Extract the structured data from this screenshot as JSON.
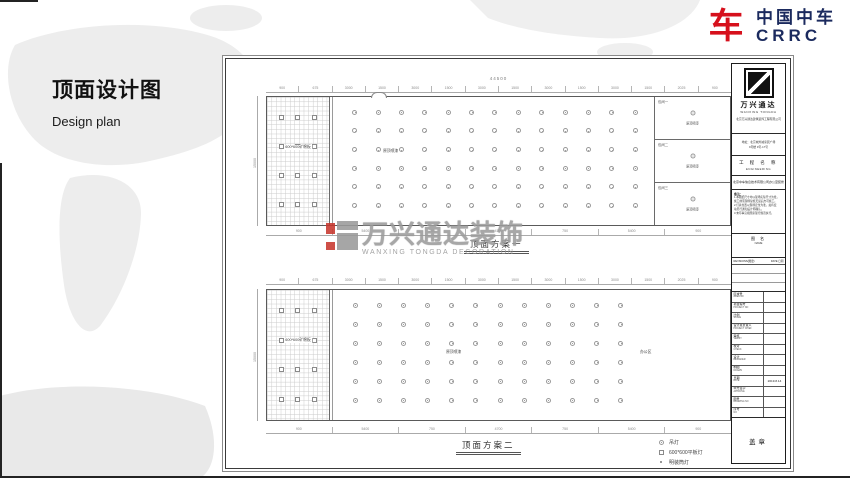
{
  "brand": {
    "glyph": "车",
    "name_cn": "中国中车",
    "name_en": "CRRC"
  },
  "page": {
    "title": "顶面设计图",
    "subtitle": "Design plan"
  },
  "watermark": {
    "name_cn": "万兴通达装饰",
    "name_en": "WANXING TONGDA DECORATION"
  },
  "colors": {
    "brand_red": "#d6101c",
    "brand_navy": "#1b2a5e",
    "watermark_gray": "#9c9c9c",
    "map_gray": "#ededed"
  },
  "plans": [
    {
      "caption": "顶面方案一",
      "total_dim": "44500",
      "left_dim": "15000",
      "grid_label": "600*600矿棉板",
      "open_label": "原顶喷漆",
      "dims_top": [
        "900",
        "675",
        "3000",
        "1500",
        "3000",
        "1500",
        "3000",
        "1500",
        "3000",
        "1500",
        "3000",
        "1500",
        "2025",
        "900"
      ],
      "dims_bottom": [
        "900",
        "5400",
        "750",
        "4700",
        "750",
        "5400",
        "900"
      ],
      "lights": {
        "cols": 13,
        "rows": 6
      },
      "panels": {
        "count": 12
      },
      "rooms": [
        {
          "name": "包间一",
          "ceiling": "原顶喷漆"
        },
        {
          "name": "包间二",
          "ceiling": "原顶喷漆"
        },
        {
          "name": "包间三",
          "ceiling": "原顶喷漆"
        }
      ]
    },
    {
      "caption": "顶面方案二",
      "total_dim": "44500",
      "left_dim": "15000",
      "grid_label": "600*600矿棉板",
      "open_label": "原顶喷漆",
      "office_label": "办公区",
      "dims_top": [
        "900",
        "675",
        "3000",
        "1500",
        "3000",
        "1500",
        "3000",
        "1500",
        "3000",
        "1500",
        "3000",
        "1500",
        "2025",
        "900"
      ],
      "dims_bottom": [
        "900",
        "5400",
        "750",
        "4700",
        "750",
        "5400",
        "900"
      ],
      "lights": {
        "cols": 12,
        "rows": 6
      },
      "panels": {
        "count": 12
      }
    }
  ],
  "legend": {
    "items": [
      {
        "symbol": "pendant",
        "label": "吊灯"
      },
      {
        "symbol": "panel",
        "label": "600*600平板灯"
      },
      {
        "symbol": "downlight",
        "label": "明装筒灯"
      }
    ]
  },
  "titleblock": {
    "company_cn": "万兴通达",
    "company_en": "WANXING TONGDA",
    "company_line": "北京万兴通达建筑装饰工程有限公司",
    "address_lines": [
      "地址：北京城外诚家居广场",
      "9号楼 9号-17号"
    ],
    "project_label_cn": "工 程 名 称",
    "project_label_en": "ENGINEERING",
    "project_name": "北京中车信息技术有限公司办公室装修",
    "notes_label": "备注：",
    "notes_lines": [
      "1.本图纸尺寸均以现场实际尺寸为准，",
      "  施工前须现场复核无误后方可施工。",
      "2.灯具位置以现场定位为准，如有变",
      "  动另行通知设计师确认。",
      "3.未尽事宜按国家现行规范执行。"
    ],
    "name_label_cn": "图 名",
    "name_label_en": "NAME",
    "revisions_label": "REVISIONS(图更)",
    "revisions_date_label": "DATE 日期",
    "rows": [
      {
        "cn": "区域号",
        "en": "AREA NO",
        "value": ""
      },
      {
        "cn": "项目编号",
        "en": "PROJECT NO",
        "value": ""
      },
      {
        "cn": "比例",
        "en": "SCALE",
        "value": ""
      },
      {
        "cn": "设计总负责人",
        "en": "PROJECT CHIEF",
        "value": ""
      },
      {
        "cn": "审核",
        "en": "VERIFY",
        "value": ""
      },
      {
        "cn": "校对",
        "en": "CHECK",
        "value": ""
      },
      {
        "cn": "设计",
        "en": "DESIGNER",
        "value": ""
      },
      {
        "cn": "制图",
        "en": "DRAWN",
        "value": ""
      },
      {
        "cn": "日期",
        "en": "DATE",
        "value": "2019.8.14"
      },
      {
        "cn": "甲方签字",
        "en": "APPROVE",
        "value": ""
      },
      {
        "cn": "图号",
        "en": "DRAWING NO",
        "value": ""
      },
      {
        "cn": "序号",
        "en": "NO",
        "value": ""
      }
    ],
    "stamp": "盖章"
  }
}
